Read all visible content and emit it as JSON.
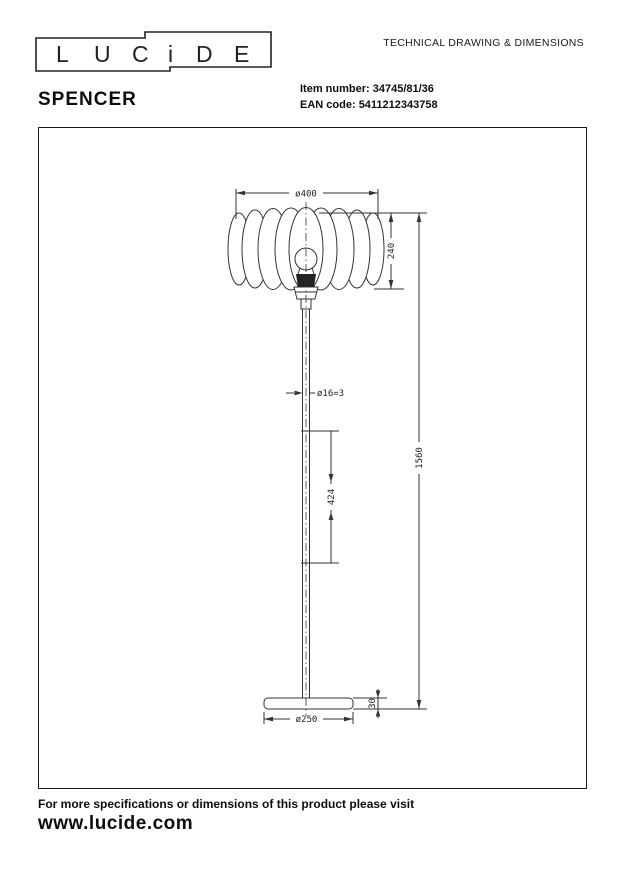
{
  "brand": {
    "logo_letters": [
      "L",
      "U",
      "C",
      "i",
      "D",
      "E"
    ]
  },
  "header": {
    "doc_title": "TECHNICAL DRAWING & DIMENSIONS",
    "product_name": "SPENCER",
    "item_number_label": "Item number:",
    "item_number_value": "34745/81/36",
    "ean_label": "EAN code:",
    "ean_value": "5411212343758"
  },
  "drawing": {
    "dims": {
      "shade_diameter": "ø400",
      "shade_height": "240",
      "tube_diameter": "ø16=3",
      "tube_section_length": "424",
      "total_height": "1560",
      "base_height": "30",
      "base_diameter": "ø250"
    }
  },
  "footer": {
    "note": "For more specifications or dimensions of this product please visit",
    "website": "www.lucide.com"
  },
  "colors": {
    "background": "#ffffff",
    "line": "#333333",
    "text": "#111111"
  }
}
